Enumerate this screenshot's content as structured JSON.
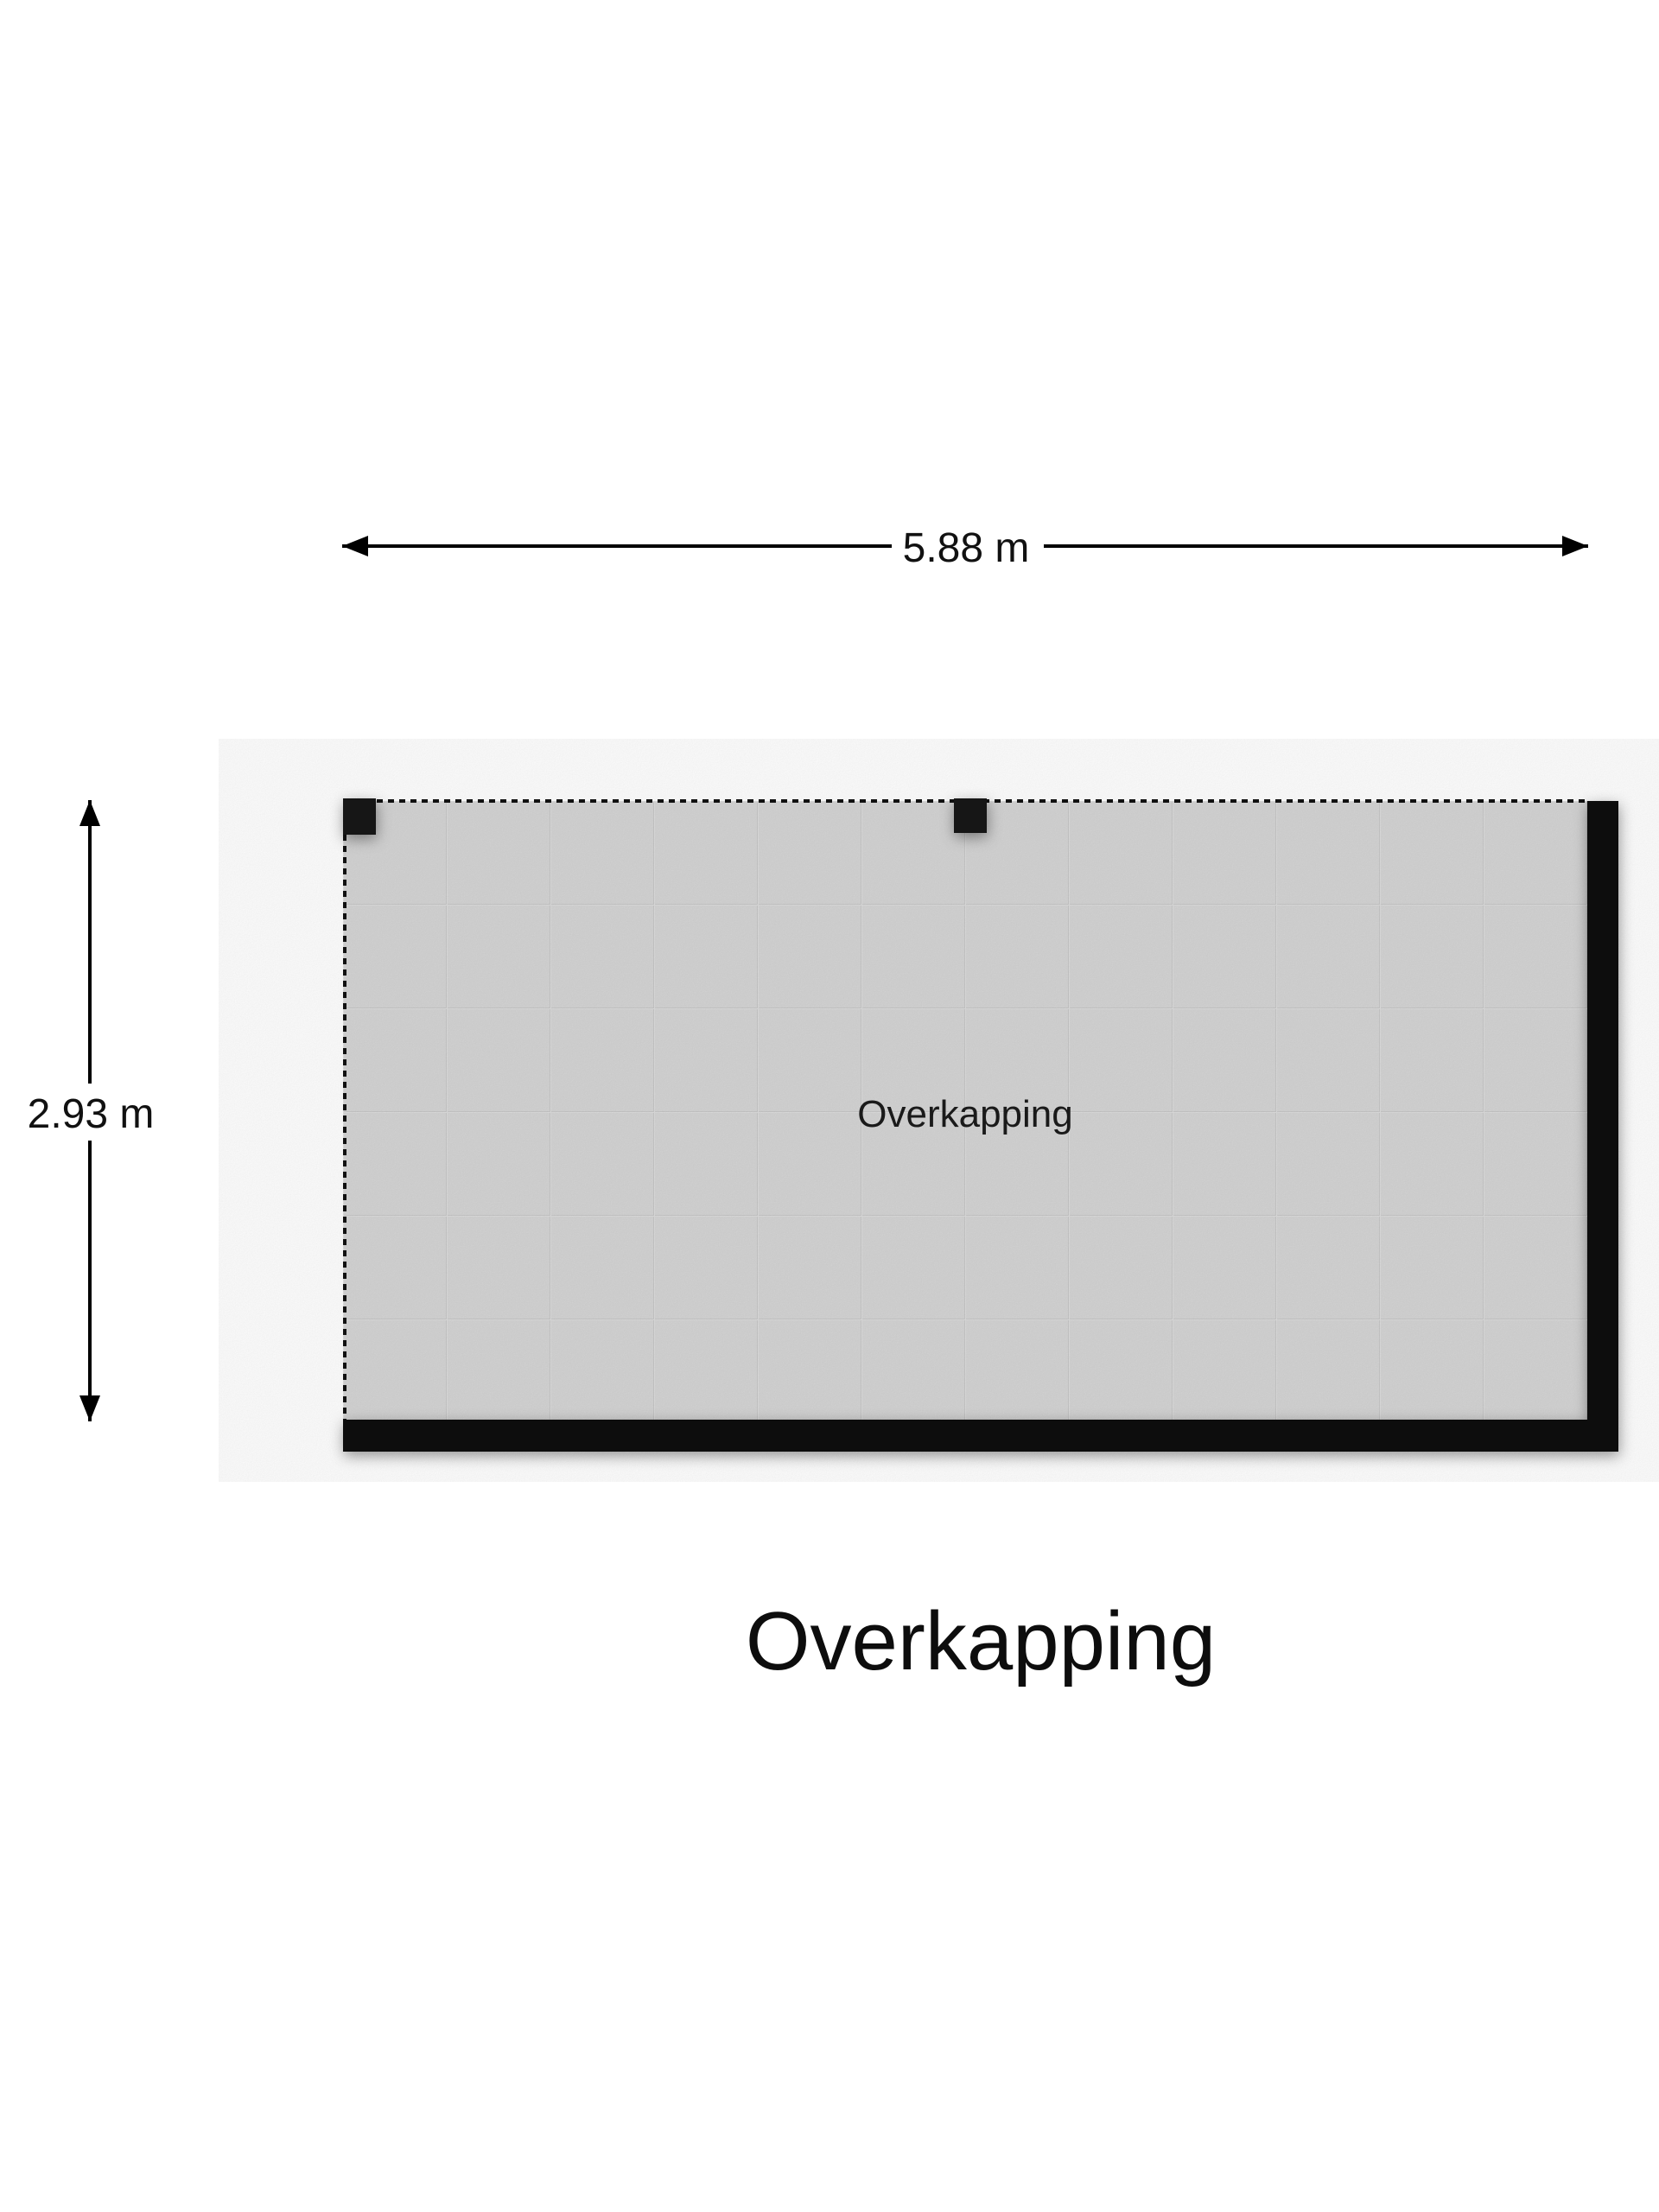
{
  "floorplan": {
    "title": "Overkapping",
    "room": {
      "label": "Overkapping"
    },
    "dimensions": {
      "width_label": "5.88 m",
      "height_label": "2.93 m"
    },
    "colors": {
      "background": "#ffffff",
      "floor": "#d5d5d5",
      "grid_line": "#c7c7c7",
      "wall": "#0a0a0a",
      "post": "#161616",
      "dashed_line": "#111111",
      "dimension_line": "#000000",
      "text": "#111111"
    }
  }
}
